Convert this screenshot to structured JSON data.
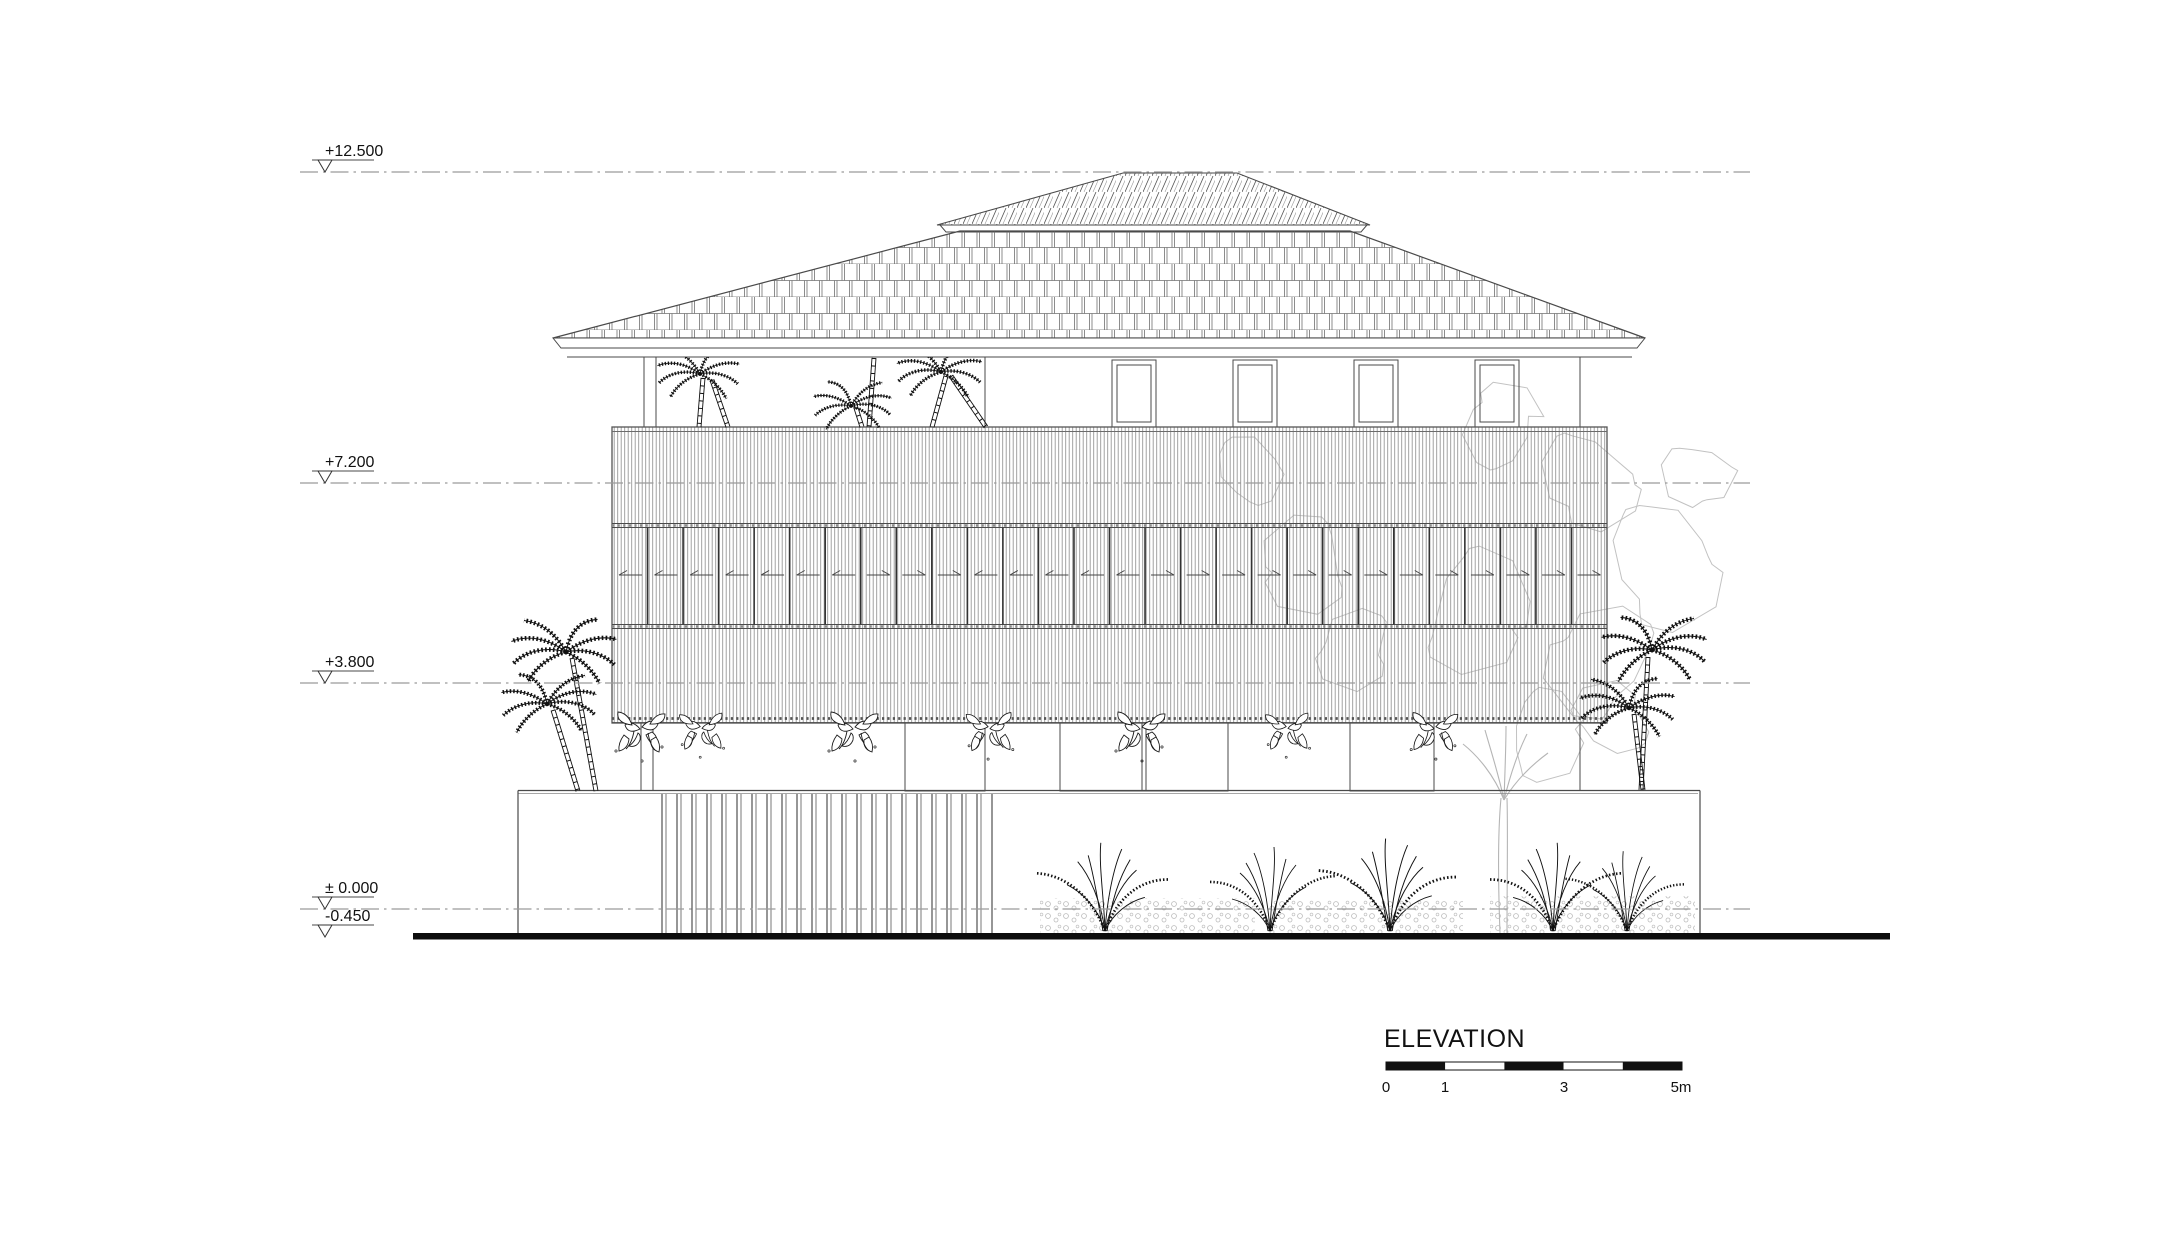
{
  "title": "ELEVATION",
  "levels": [
    {
      "label": "+12.500"
    },
    {
      "label": "+7.200"
    },
    {
      "label": "+3.800"
    },
    {
      "label": "± 0.000"
    },
    {
      "label": "-0.450"
    }
  ],
  "scale_bar": {
    "labels": [
      "0",
      "1",
      "3",
      "5m"
    ]
  },
  "colors": {
    "line": "#4a4a4a",
    "level_line": "#9b9b9b",
    "ground": "#0d0d0d",
    "vegetation_background": "#c2c2c2",
    "text": "#111111"
  }
}
